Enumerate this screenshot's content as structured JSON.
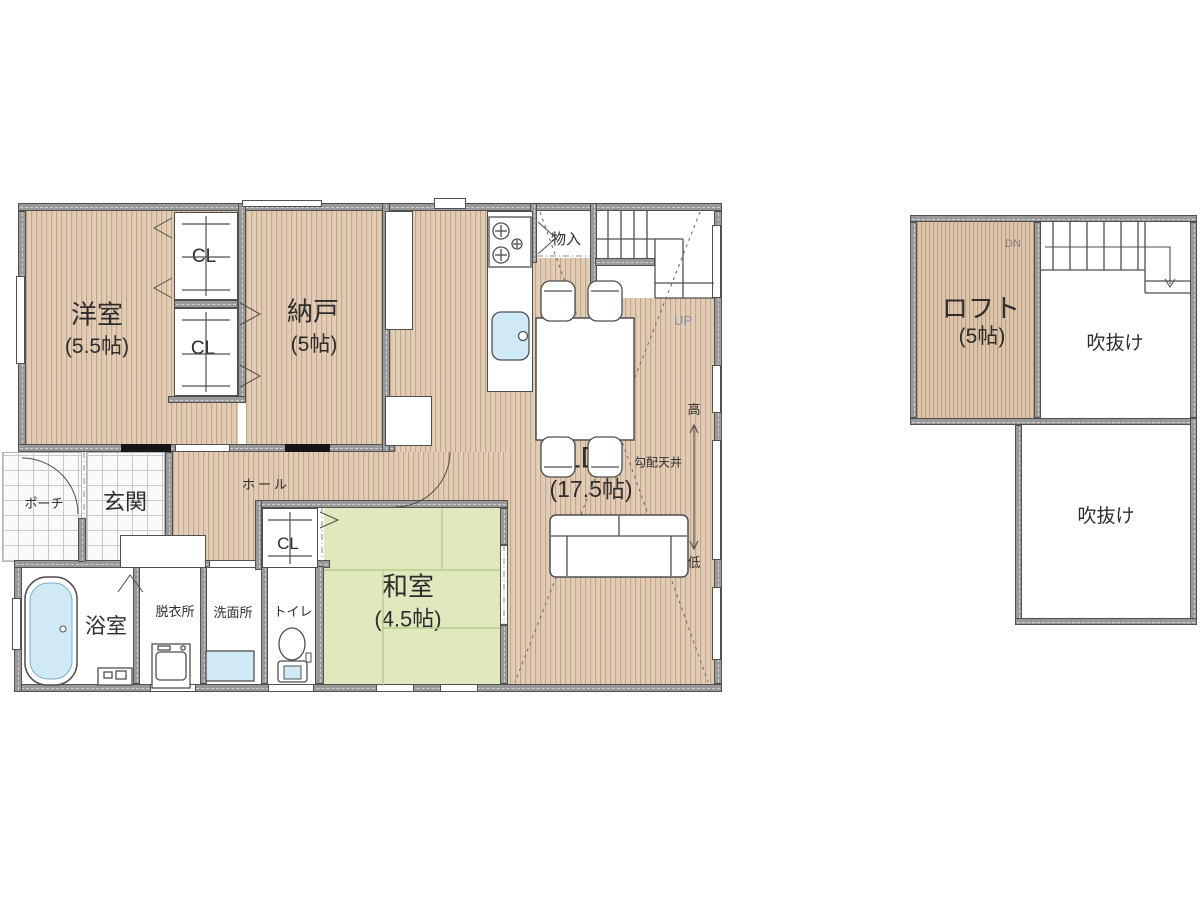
{
  "first_floor": {
    "western_room": {
      "name": "洋室",
      "size": "(5.5帖)"
    },
    "storage_room": {
      "name": "納戸",
      "size": "(5帖)"
    },
    "storage_small": "物入",
    "ldk": {
      "name": "LDK",
      "size": "(17.5帖)"
    },
    "sloped_ceiling": "勾配天井",
    "ceiling_high": "高",
    "ceiling_low": "低",
    "stairs_up": "UP",
    "hall": "ホール",
    "entrance": "玄関",
    "porch": "ポーチ",
    "japanese_room": {
      "name": "和室",
      "size": "(4.5帖)"
    },
    "bathroom": "浴室",
    "changing_room": "脱衣所",
    "washroom": "洗面所",
    "toilet": "トイレ",
    "closet": "CL"
  },
  "loft_floor": {
    "loft": {
      "name": "ロフト",
      "size": "(5帖)"
    },
    "void_upper": "吹抜け",
    "void_lower": "吹抜け",
    "stairs_down": "DN"
  },
  "colors": {
    "wood_floor": "#dcc5ac",
    "wood_stripe": "#c4a485",
    "loft_wood": "#d9bfa4",
    "tatami": "#dfe9bd",
    "wall": "#999999",
    "water": "#cfe9f6",
    "up_dn_label": "#8691a8"
  }
}
